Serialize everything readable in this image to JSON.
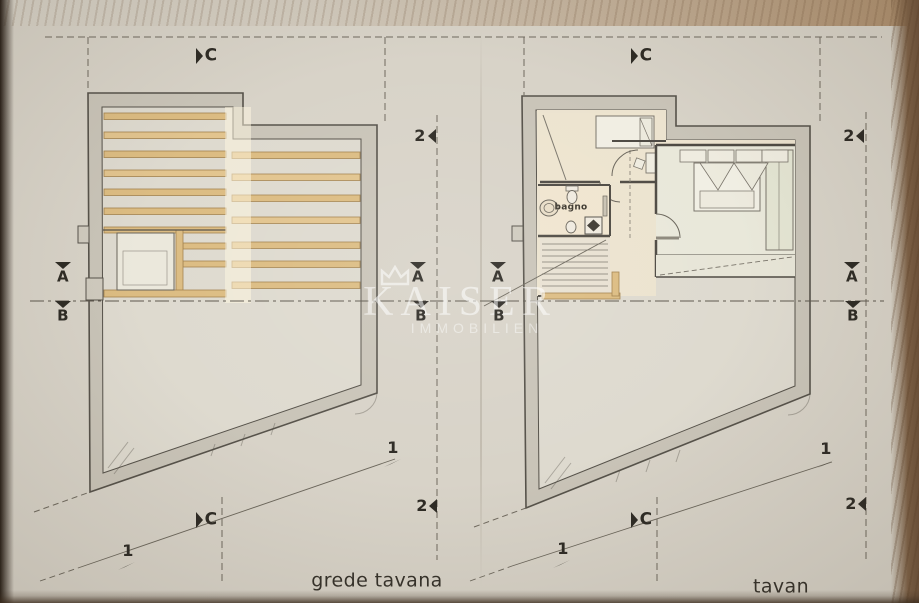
{
  "watermark": {
    "brand": "KAISER",
    "subtitle": "IMMOBILIEN"
  },
  "section_markers": {
    "c": "C",
    "a": "A",
    "b": "B",
    "one": "1",
    "two": "2"
  },
  "plan_labels": {
    "left_caption": "grede tavana",
    "right_caption": "tavan",
    "bathroom": "bagno"
  },
  "palette": {
    "paper": "#d8d3c8",
    "plan_interior": "#dedacf",
    "wall_fill": "#c9c4b8",
    "ink_line": "#56524a",
    "beam_wood": "#dcbc82",
    "room_warm": "#ece3cf",
    "bedroom_floor": "#e9e8da",
    "marker_text": "#2e2b25",
    "wood_table_edge": "#7b5f45",
    "watermark": "#ffffff"
  }
}
